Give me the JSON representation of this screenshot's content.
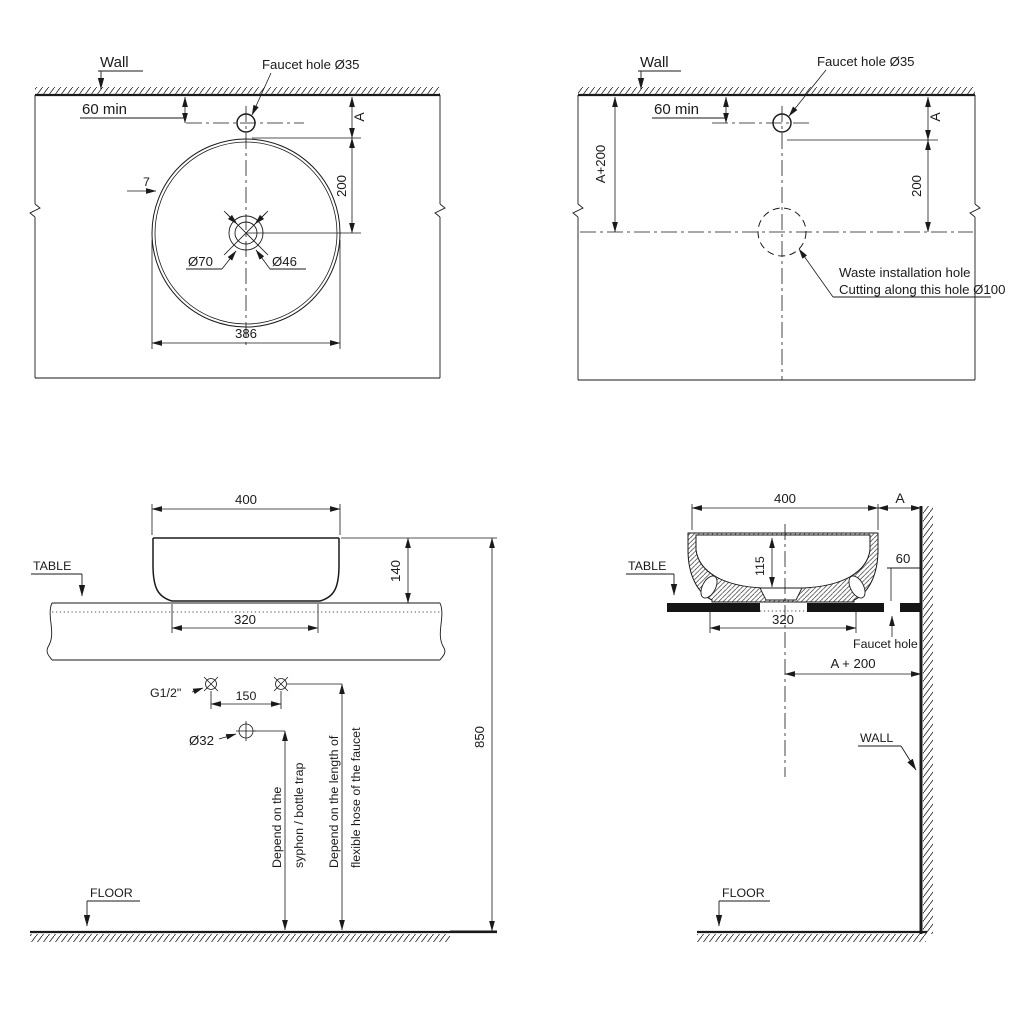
{
  "drawing": {
    "top_left": {
      "wall": "Wall",
      "faucet": "Faucet hole Ø35",
      "min60": "60 min",
      "dim_a": "A",
      "dim_200": "200",
      "dim_7": "7",
      "dim_d70": "Ø70",
      "dim_d46": "Ø46",
      "dim_386": "386"
    },
    "top_right": {
      "wall": "Wall",
      "faucet": "Faucet hole Ø35",
      "min60": "60 min",
      "dim_a_plus_200": "A+200",
      "dim_a": "A",
      "dim_200": "200",
      "waste_note_1": "Waste installation hole",
      "waste_note_2": "Cutting along this hole Ø100"
    },
    "bottom_left": {
      "table": "TABLE",
      "floor": "FLOOR",
      "dim_400": "400",
      "dim_140": "140",
      "dim_320": "320",
      "dim_850": "850",
      "g_half": "G1/2\"",
      "dim_150": "150",
      "dim_d32": "Ø32",
      "note_syphon_1": "Depend on the",
      "note_syphon_2": "syphon / bottle trap",
      "note_hose_1": "Depend on the length of",
      "note_hose_2": "flexible hose of the faucet"
    },
    "bottom_right": {
      "table": "TABLE",
      "wall": "WALL",
      "floor": "FLOOR",
      "faucet_hole": "Faucet hole",
      "dim_400": "400",
      "dim_a": "A",
      "dim_115": "115",
      "dim_60": "60",
      "dim_320": "320",
      "dim_a_plus_200": "A + 200"
    }
  }
}
